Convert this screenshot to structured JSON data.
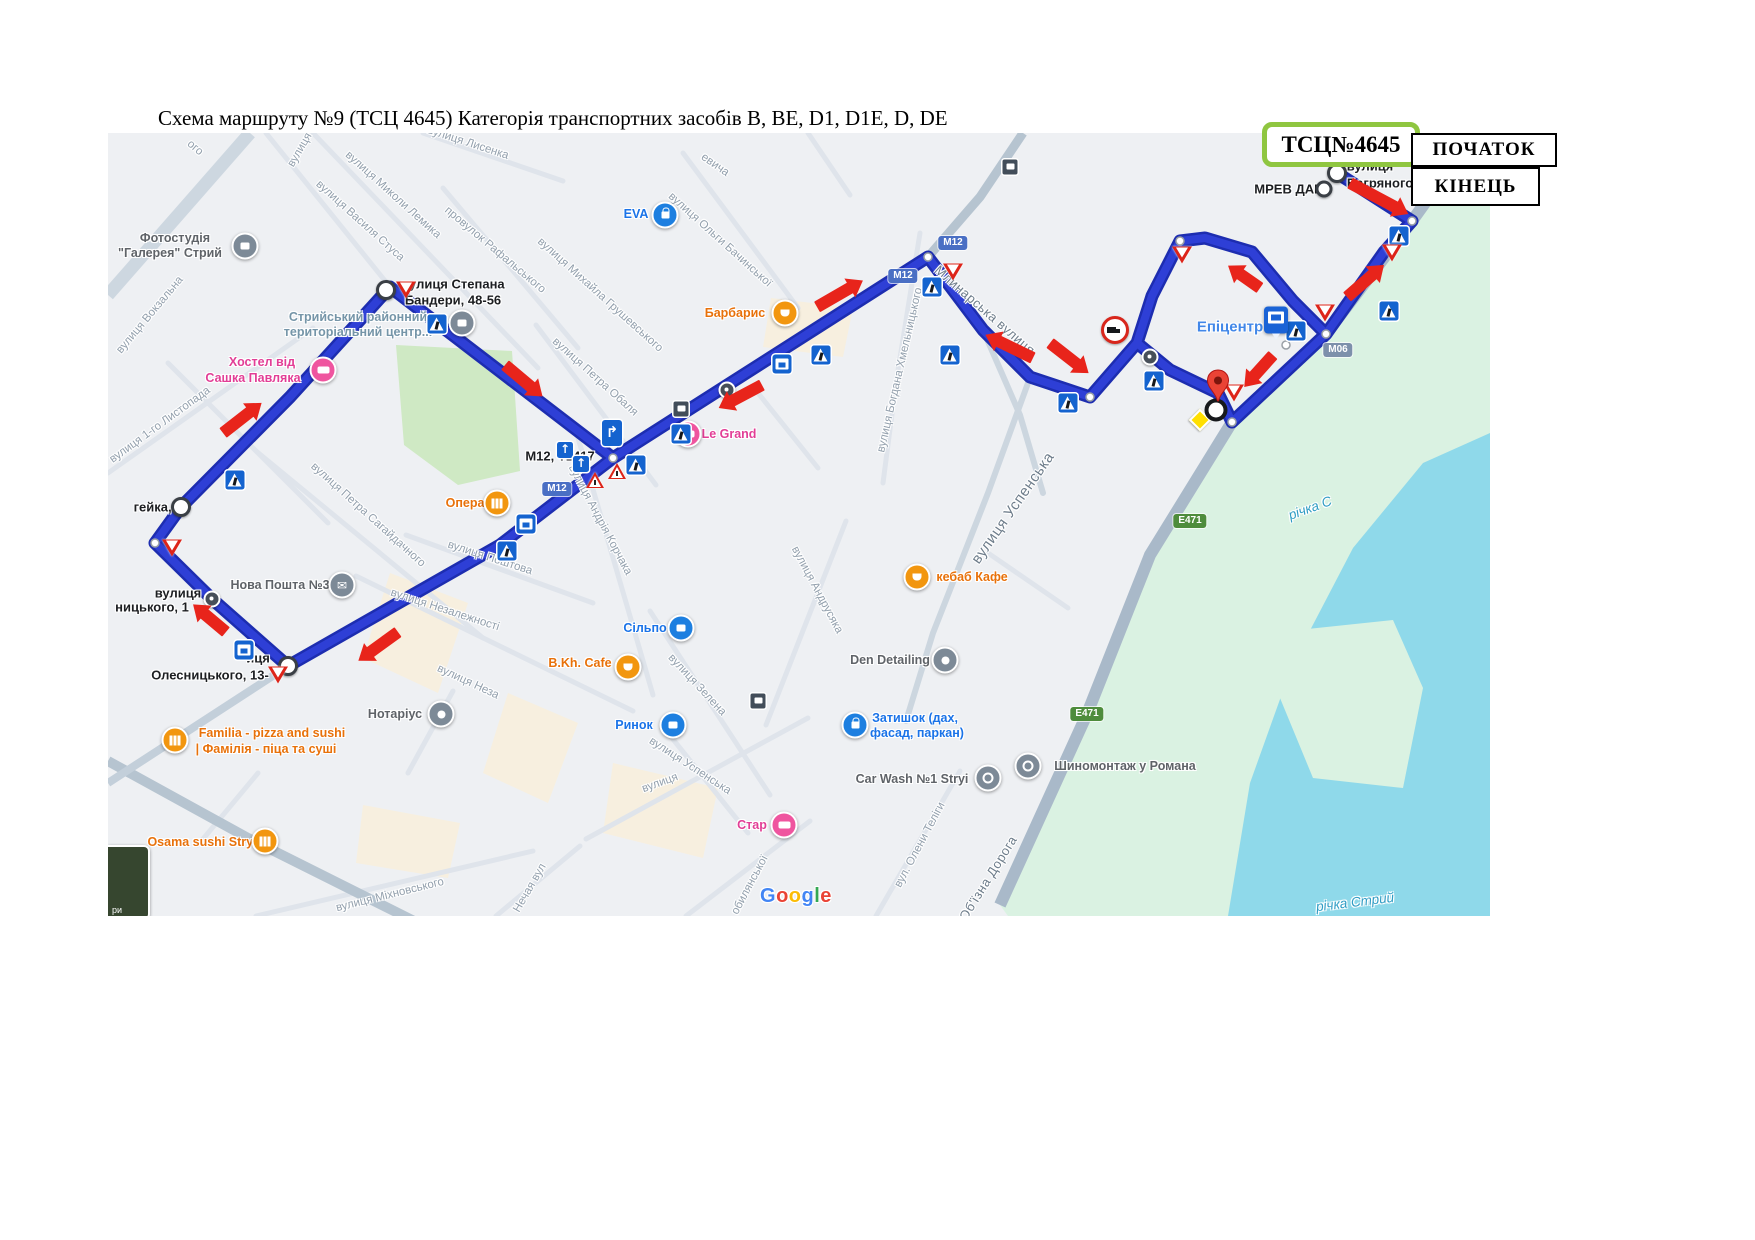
{
  "title": "Схема маршруту №9 (ТСЦ 4645) Категорія транспортних засобів B, BE, D1, D1E, D, DE",
  "legend": {
    "tsc": "ТСЦ№4645",
    "start": "ПОЧАТОК",
    "end": "КІНЕЦЬ"
  },
  "toggle": "ри",
  "google": [
    "G",
    "o",
    "o",
    "g",
    "l",
    "e"
  ],
  "shields": {
    "m12": "М12",
    "m06": "M06",
    "e471": "E471"
  },
  "rivers": {
    "main": "річка Стрий",
    "upper": "річка С"
  },
  "labels": {
    "streets": {
      "vokzalna": "вулиця Вокзальна",
      "lystopada": "вулиця 1-го Листопада",
      "lemyka": "вулиця Миколи Лемика",
      "stusa": "вулиця Василя Стуса",
      "rafalskoho": "провулок Рафальського",
      "lysenka": "вулиця Лисенка",
      "frag_vulytsia_top": "вулиця",
      "frag_oho": "ого",
      "hrushevskoho": "вулиця Михайла Грушевського",
      "bachynskoi": "вулиця Ольги Бачинської",
      "frag_evycha": "евича",
      "obalia": "вулиця Петра Обаля",
      "sahaidachnoho": "вулиця Петра Сагайдачного",
      "korchaka": "вулиця Андрія Корчака",
      "poshtova": "вулиця Поштова",
      "nezalezhnosti": "вулиця Незалежності",
      "frag_neza": "вулиця Неза",
      "zelena": "вулиця Зелена",
      "uspenska_small": "вулиця Успенська",
      "andrusiaka": "вулиця Андрусяка",
      "uspenska_big": "вулиця Успенська",
      "khmelnytskoho": "вулиця Богдана Хмельницького",
      "mlynarska": "Млинарська вулиця",
      "telihy": "вул. Олени Теліги",
      "mikhnovskoho": "вулиця Міхновського",
      "nechaia": "Нечая вул",
      "kobylianskoi": "обилянської",
      "frag_vulytsia_bottom": "вулиця",
      "obizna": "Об'їзна Дорога"
    },
    "waypoints": {
      "bandery_1": "вулиця Степана",
      "bandery_2": "Бандери, 48-56",
      "heika": "гейка, 3",
      "oles_a1": "вулиця",
      "oles_a2": "ницького, 1",
      "oles_b": "Олесницького, 13-",
      "frag_ytsia": "иця",
      "mrev": "МРЕВ ДАІ",
      "bahr_1": "вулиця",
      "bahr_2": "Багряного",
      "m12_t": "М12, Т1417"
    },
    "pois": {
      "photo_1": "Фотостудія",
      "photo_2": "\"Галерея\" Стрий",
      "eva": "EVA",
      "barbarys": "Барбарис",
      "hostel_1": "Хостел від",
      "hostel_2": "Сашка Павляка",
      "tercentr_1": "Стрийський районний",
      "tercentr_2": "територіальний центр...",
      "opera": "Опера",
      "legrand": "Le Grand",
      "novaposhta": "Нова Пошта №3",
      "silpo": "Сільпо",
      "bkh": "B.Kh. Cafe",
      "rynok": "Ринок",
      "kebab": "кебаб Кафе",
      "den": "Den Detailing",
      "zatyshok_1": "Затишок (дах,",
      "zatyshok_2": "фасад, паркан)",
      "carwash": "Car Wash №1 Stryi",
      "shyno": "Шиномонтаж у Романа",
      "star": "Стар",
      "familia_1": "Familia - pizza and sushi",
      "familia_2": "| Фамілія - піца та суші",
      "osama": "Osama sushi Stryi",
      "notarius": "Нотаріус",
      "epicentr": "Епіцентр"
    }
  },
  "colors": {
    "route": "#2e3fd6",
    "route_casing": "#1d2db0",
    "arrow": "#e8241b",
    "water": "#8fd9ea",
    "floodplain": "#daf2e2",
    "park": "#cfe9c4",
    "legend_border": "#8fc640",
    "sign_blue": "#1463cf",
    "sign_red": "#dd2419",
    "google_letters": [
      "#4285F4",
      "#EA4335",
      "#FBBC05",
      "#4285F4",
      "#34A853",
      "#EA4335"
    ]
  }
}
